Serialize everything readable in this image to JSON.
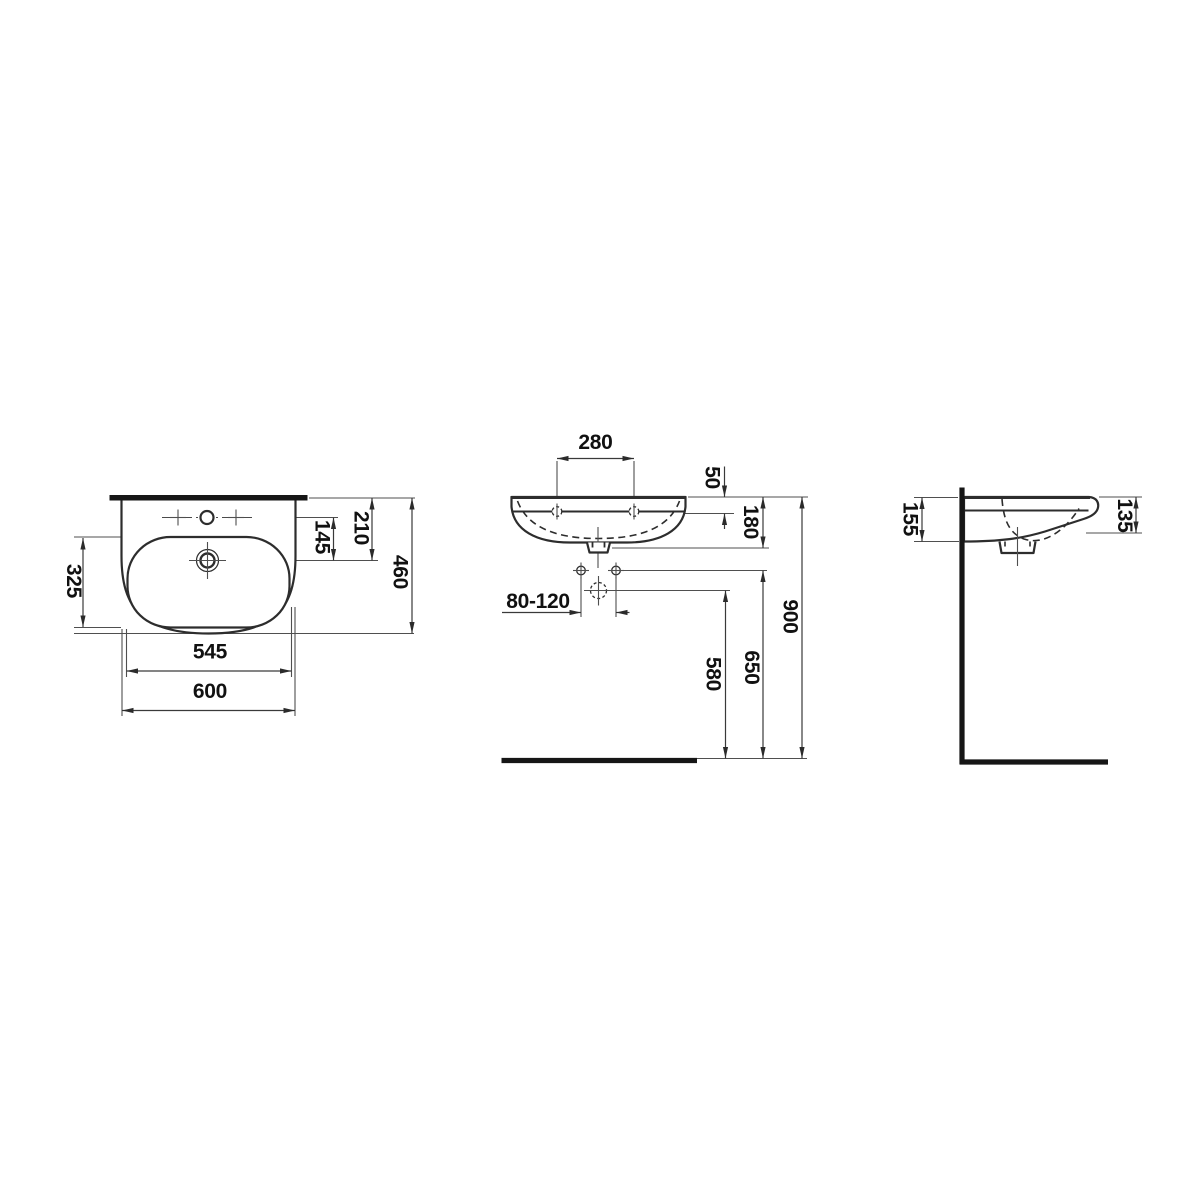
{
  "colors": {
    "background": "#ffffff",
    "outline": "#2d2d2d",
    "thin_line": "#4f4f4f",
    "heavy_line": "#161616",
    "text": "#111111"
  },
  "plan": {
    "dims": {
      "bowl_depth": "325",
      "tap_to_drain": "145",
      "edge_to_drain": "210",
      "overall_depth": "460",
      "bowl_width": "545",
      "overall_width": "600"
    }
  },
  "front": {
    "dims": {
      "tap_hole_spacing": "280",
      "rim_to_fixing_holes": "50",
      "body_height": "180",
      "fixing_hole_spacing": "80-120",
      "trap_height": "580",
      "drain_height": "650",
      "rim_height": "900"
    }
  },
  "side": {
    "dims": {
      "rear_height": "155",
      "front_height": "135"
    }
  }
}
